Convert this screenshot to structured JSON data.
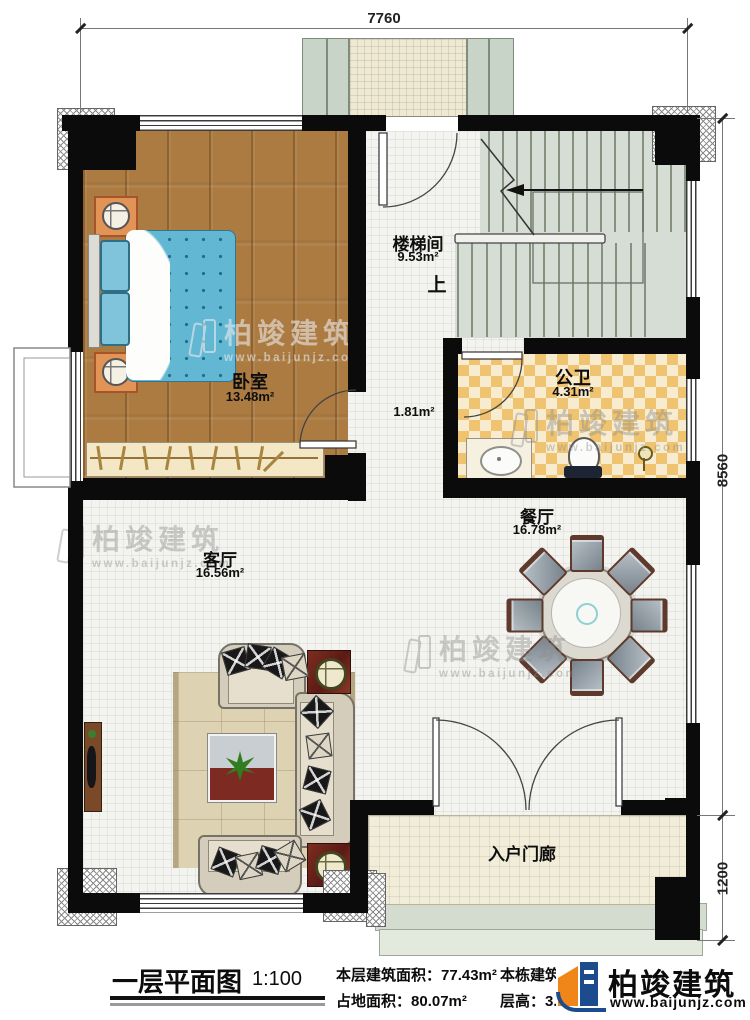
{
  "dimensions": {
    "top_width": "7760",
    "right_height": "8560",
    "right_porch": "1200"
  },
  "rooms": {
    "bedroom": {
      "name": "卧室",
      "area": "13.48m²"
    },
    "stairwell": {
      "name": "楼梯间",
      "area": "9.53m²"
    },
    "hall": {
      "area": "1.81m²"
    },
    "bathroom": {
      "name": "公卫",
      "area": "4.31m²"
    },
    "dining": {
      "name": "餐厅",
      "area": "16.78m²"
    },
    "living": {
      "name": "客厅",
      "area": "16.56m²"
    },
    "porch": {
      "name": "入户门廊"
    }
  },
  "stairs": {
    "up_label": "上"
  },
  "footer": {
    "title": "一层平面图",
    "scale": "1:100",
    "floor_area_label": "本层建筑面积：",
    "floor_area_value": "77.43m²",
    "footprint_label": "占地面积：",
    "footprint_value": "80.07m²",
    "total_area_label": "本栋建筑面积：",
    "total_area_value": "232.29m²",
    "height_label": "层高：",
    "height_value": "3.0m"
  },
  "brand": {
    "name": "柏竣建筑",
    "website": "www.baijunjz.com"
  },
  "watermark": {
    "name": "柏竣建筑",
    "website": "www.baijunjz.com"
  }
}
